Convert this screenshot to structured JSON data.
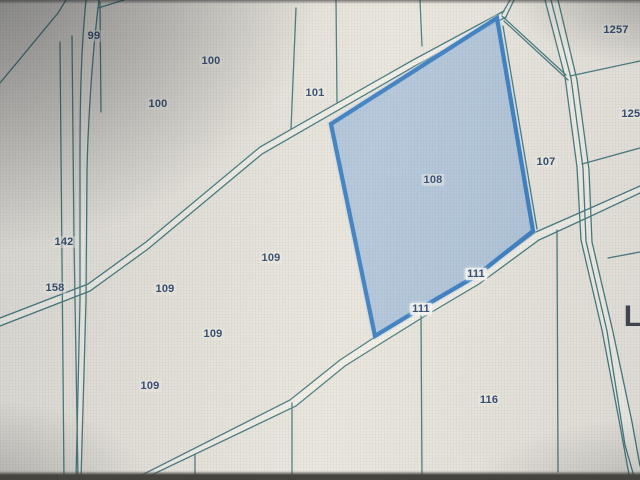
{
  "app": {
    "description": "Cadastral parcel map view (photographed screen)",
    "selected_parcel_id": "108"
  },
  "map": {
    "selected_parcel": {
      "id": "108"
    },
    "labels": [
      {
        "text": "99",
        "x": 94,
        "y": 36,
        "kind": "parcel"
      },
      {
        "text": "100",
        "x": 211,
        "y": 61,
        "kind": "parcel"
      },
      {
        "text": "100",
        "x": 158,
        "y": 104,
        "kind": "parcel"
      },
      {
        "text": "101",
        "x": 315,
        "y": 93,
        "kind": "parcel"
      },
      {
        "text": "1257",
        "x": 616,
        "y": 30,
        "kind": "parcel"
      },
      {
        "text": "1258",
        "x": 634,
        "y": 114,
        "kind": "parcel"
      },
      {
        "text": "107",
        "x": 546,
        "y": 162,
        "kind": "parcel"
      },
      {
        "text": "108",
        "x": 433,
        "y": 180,
        "kind": "parcel",
        "selected": true
      },
      {
        "text": "142",
        "x": 64,
        "y": 242,
        "kind": "parcel"
      },
      {
        "text": "158",
        "x": 55,
        "y": 288,
        "kind": "parcel"
      },
      {
        "text": "109",
        "x": 271,
        "y": 258,
        "kind": "parcel"
      },
      {
        "text": "109",
        "x": 165,
        "y": 289,
        "kind": "parcel"
      },
      {
        "text": "109",
        "x": 213,
        "y": 334,
        "kind": "parcel"
      },
      {
        "text": "109",
        "x": 150,
        "y": 386,
        "kind": "parcel"
      },
      {
        "text": "111",
        "x": 476,
        "y": 274,
        "kind": "boundary"
      },
      {
        "text": "111",
        "x": 421,
        "y": 309,
        "kind": "boundary"
      },
      {
        "text": "116",
        "x": 489,
        "y": 400,
        "kind": "parcel"
      },
      {
        "text": "L",
        "x": 633,
        "y": 317,
        "kind": "place"
      }
    ]
  },
  "colors": {
    "bg": "#e9e6df",
    "line": "#3a747b",
    "roadFill": "#f3f1ea",
    "parcelFill": "#9fbcdb",
    "parcelBorder": "#2e78c2",
    "parcelHalo": "#bcd3ea",
    "label": "#24406b",
    "placeLabel": "#343b46"
  }
}
